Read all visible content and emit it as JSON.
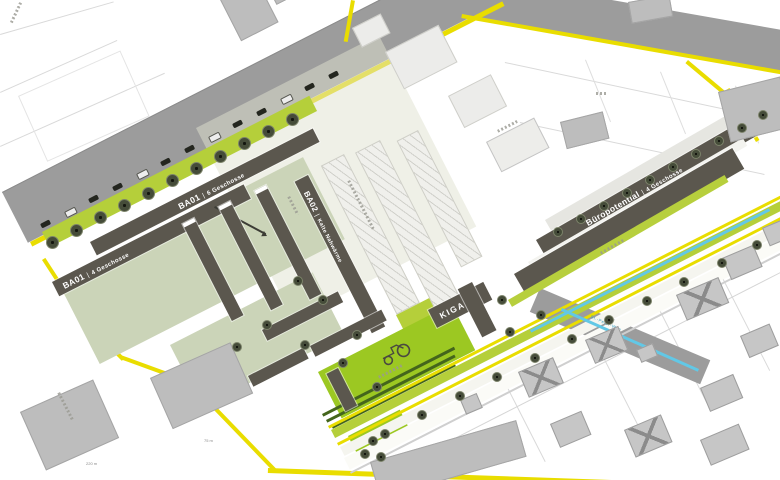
{
  "plan": {
    "type": "urban-development-site-plan",
    "areas": {
      "ba01_upper": {
        "code": "BA01",
        "divider": "|",
        "desc": "6 Geschosse"
      },
      "ba01_lower": {
        "code": "BA01",
        "divider": "|",
        "desc": "4 Geschosse"
      },
      "ba02": {
        "code": "BA02",
        "divider": "|",
        "desc": "Kalte Nahwärme"
      },
      "buero": {
        "code": "Büropotential",
        "divider": "|",
        "desc": "4 Geschosse"
      },
      "kiga": {
        "code": "KIGA"
      }
    },
    "annotations": {
      "street_blue": "St.-Peter-Weg",
      "dist_long": "220 m",
      "dist_short": "75 m"
    },
    "colors": {
      "road": "#9c9c9c",
      "route_yellow": "#e9dd00",
      "green_strip": "#b5cf3a",
      "playground_green": "#9cc822",
      "courtyard_green": "#cbd4b8",
      "new_building": "#5b574e",
      "existing_building": "#c6c6c6",
      "water_blue": "#62c8e6"
    }
  }
}
